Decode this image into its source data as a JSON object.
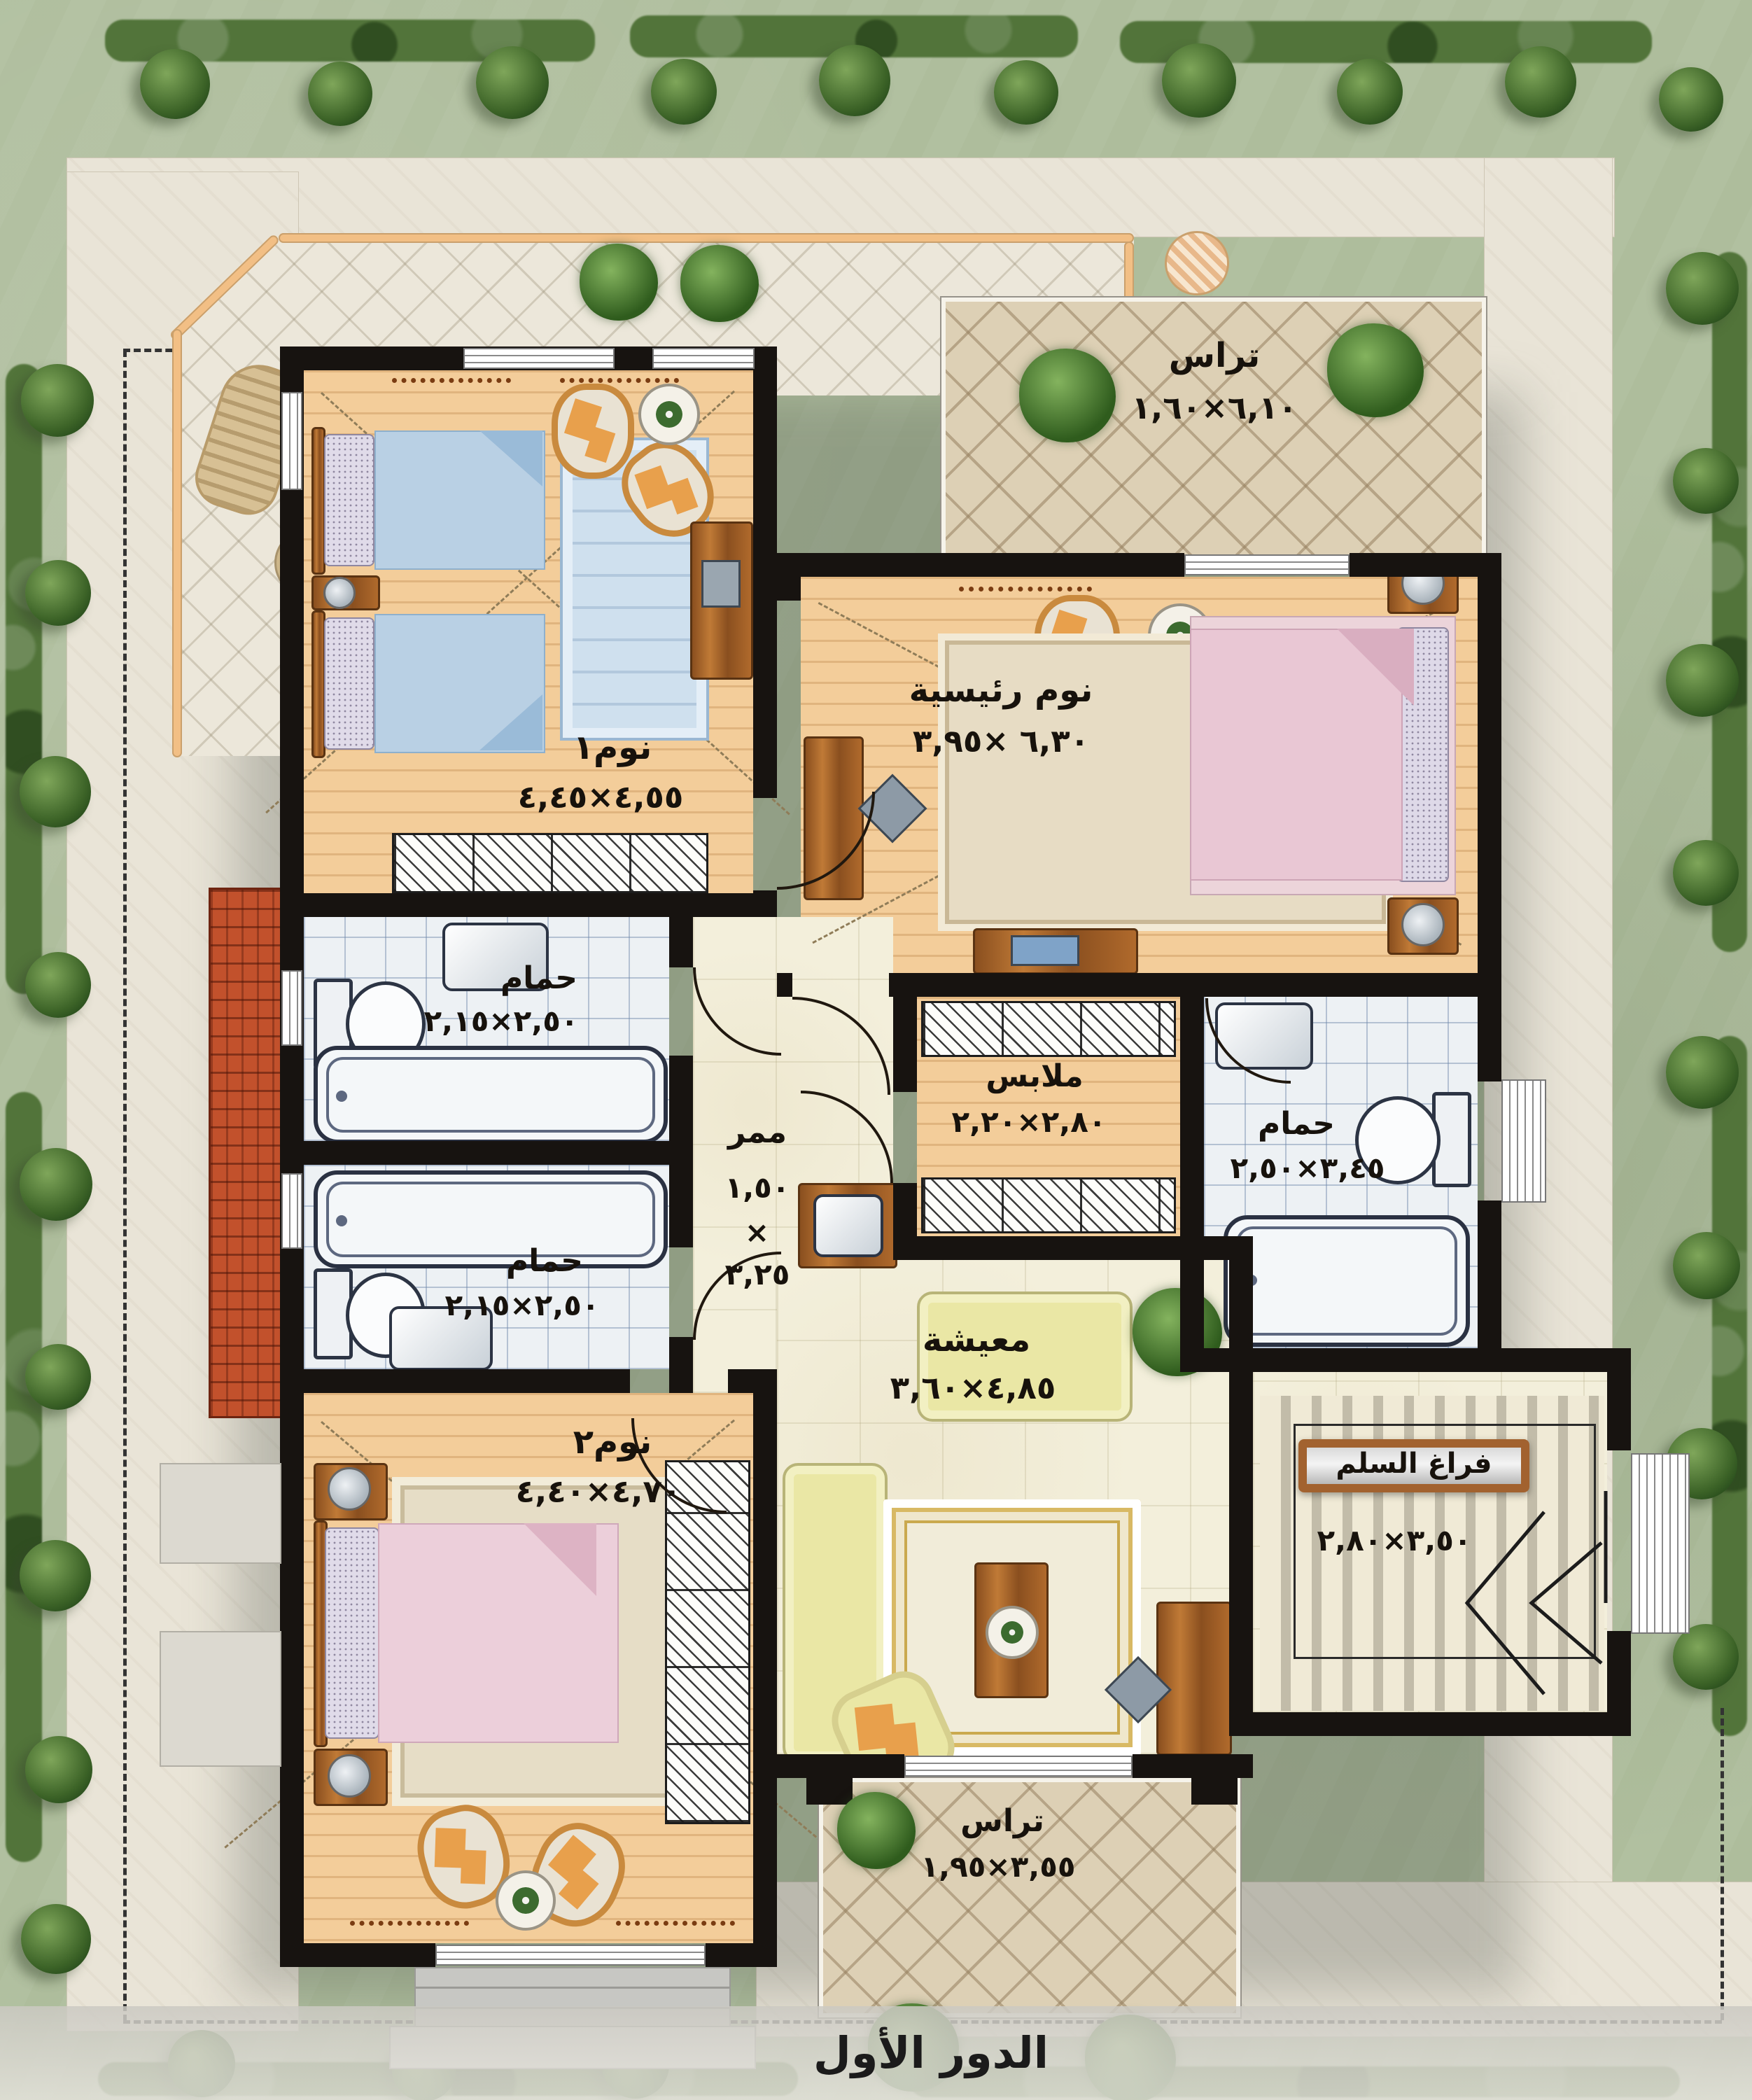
{
  "caption": "الدور الأول",
  "palette": {
    "wall": "#171310",
    "wood_floor": "#f3cd9a",
    "marble_floor": "#f3efdb",
    "bath_tile": "#edf1f4",
    "terrace_tile": "#ddd0b5",
    "roof_tile": "#c2512b",
    "walkway_border": "#f2bf85",
    "sofa": "#eae7a5",
    "garden": "#aebd9c"
  },
  "rooms": [
    {
      "id": "terrace-top",
      "name": "تراس",
      "dims": "٦,١٠×١,٦٠"
    },
    {
      "id": "master-bedroom",
      "name": "نوم رئيسية",
      "dims": "٦,٣٠ ×٣,٩٥"
    },
    {
      "id": "bedroom-1",
      "name": "نوم١",
      "dims": "٤,٥٥×٤,٤٥"
    },
    {
      "id": "bath-1",
      "name": "حمام",
      "dims": "٢,٥٠×٢,١٥"
    },
    {
      "id": "dressing",
      "name": "ملابس",
      "dims": "٢,٨٠×٢,٢٠"
    },
    {
      "id": "corridor",
      "name": "ممر",
      "w": "١,٥٠",
      "x": "×",
      "h": "٣,٢٥"
    },
    {
      "id": "bath-master",
      "name": "حمام",
      "dims": "٣,٤٥×٢,٥٠"
    },
    {
      "id": "bath-2",
      "name": "حمام",
      "dims": "٢,٥٠×٢,١٥"
    },
    {
      "id": "bedroom-2",
      "name": "نوم٢",
      "dims": "٤,٧٠×٤,٤٠"
    },
    {
      "id": "living",
      "name": "معيشة",
      "dims": "٤,٨٥×٣,٦٠"
    },
    {
      "id": "stairwell",
      "name": "فراغ السلم",
      "dims": "٣,٥٠×٢,٨٠"
    },
    {
      "id": "terrace-bottom",
      "name": "تراس",
      "dims": "٣,٥٥×١,٩٥"
    }
  ]
}
